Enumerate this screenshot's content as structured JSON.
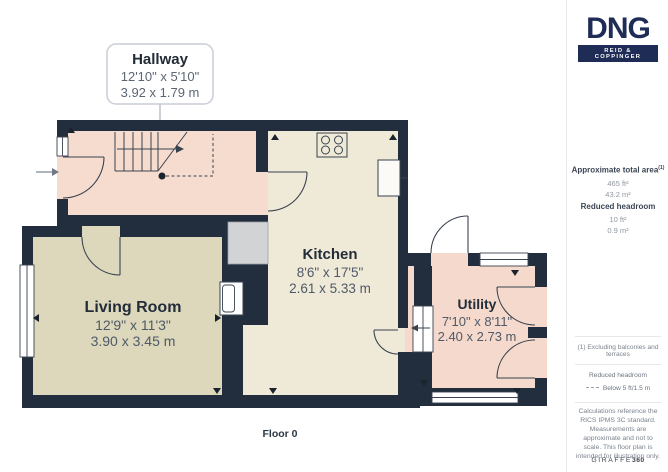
{
  "plan": {
    "floor_label": "Floor 0",
    "callout": {
      "title": "Hallway",
      "imperial": "12'10\" x 5'10\"",
      "metric": "3.92 x 1.79 m"
    },
    "rooms": {
      "living": {
        "name": "Living Room",
        "imperial": "12'9\" x 11'3\"",
        "metric": "3.90 x 3.45 m"
      },
      "kitchen": {
        "name": "Kitchen",
        "imperial": "8'6\" x 17'5\"",
        "metric": "2.61 x 5.33 m"
      },
      "utility": {
        "name": "Utility",
        "imperial": "7'10\" x 8'11\"",
        "metric": "2.40 x 2.73 m"
      }
    },
    "colors": {
      "wall": "#222d3d",
      "hallway_floor": "#f6dbcf",
      "utility_floor": "#f5d9cc",
      "living_floor": "#ddd7bb",
      "kitchen_floor": "#efe9d7",
      "storage_gray": "#d2d3d5",
      "fixture_line": "#39434f"
    }
  },
  "sidebar": {
    "brand": {
      "name": "DNG",
      "tagline": "REID & COPPINGER"
    },
    "area": {
      "title": "Approximate total area",
      "title_superscript": "(1)",
      "value_imperial": "465 ft²",
      "value_metric": "43.2 m²"
    },
    "reduced_headroom": {
      "title": "Reduced headroom",
      "value_imperial": "10 ft²",
      "value_metric": "0.9 m²"
    },
    "footnote": "(1) Excluding balconies and terraces",
    "legend": {
      "title": "Reduced headroom",
      "label": "Below 5 ft/1.5 m"
    },
    "disclaimer": "Calculations reference the RICS IPMS 3C standard. Measurements are approximate and not to scale. This floor plan is intended for illustration only.",
    "logo": {
      "part1": "GIRAFFE",
      "part2": "360"
    }
  }
}
